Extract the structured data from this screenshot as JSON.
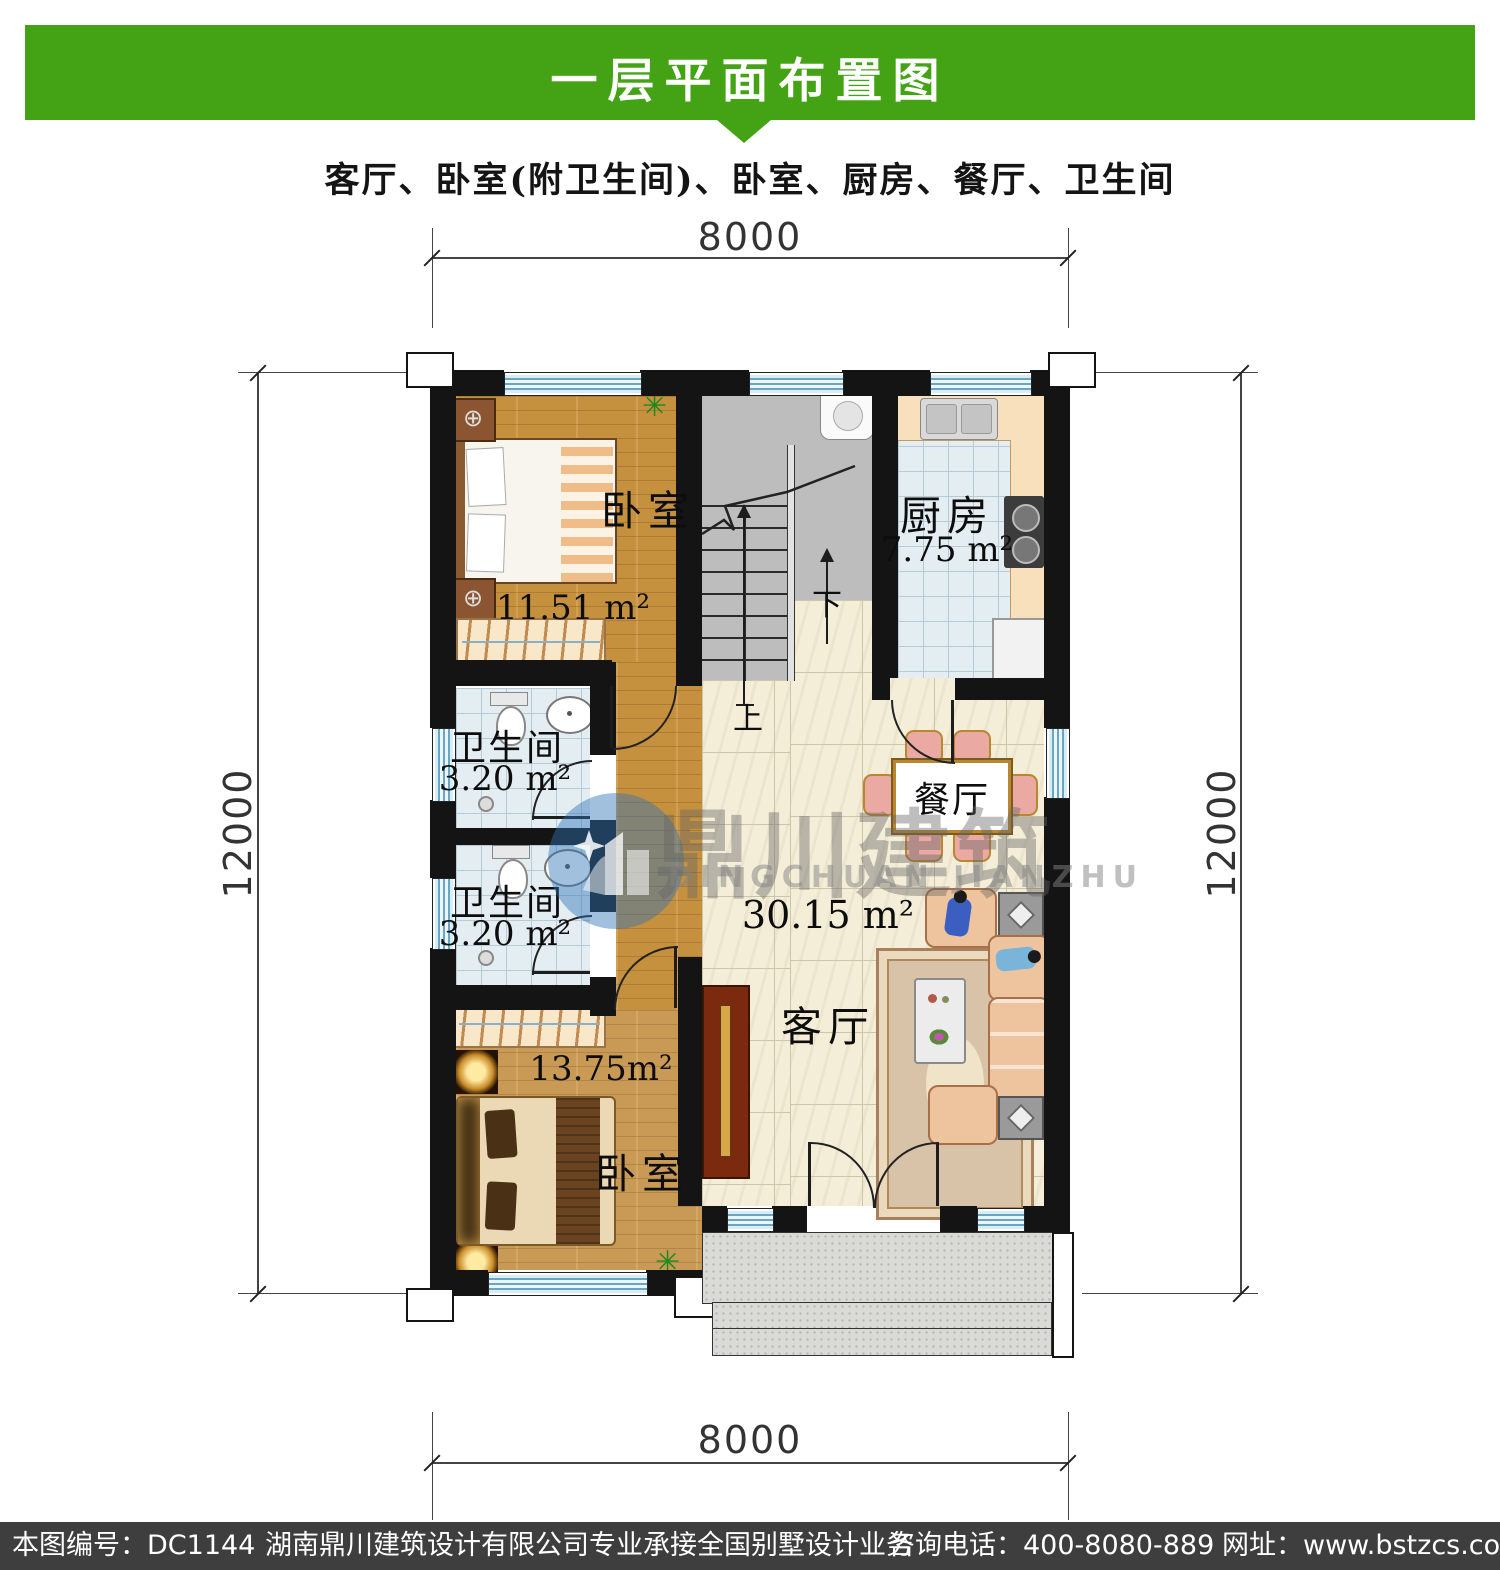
{
  "header": {
    "title": "一层平面布置图",
    "subtitle": "客厅、卧室(附卫生间)、卧室、厨房、餐厅、卫生间"
  },
  "dimensions": {
    "top": "8000",
    "bottom": "8000",
    "left": "12000",
    "right": "12000"
  },
  "rooms": {
    "bedroom_top": {
      "name": "卧室",
      "area": "11.51 m²"
    },
    "kitchen": {
      "name": "厨房",
      "area": "7.75 m²"
    },
    "bath_upper": {
      "name": "卫生间",
      "area": "3.20 m²"
    },
    "bath_lower": {
      "name": "卫生间",
      "area": "3.20 m²"
    },
    "dining": {
      "name": "餐厅"
    },
    "living": {
      "name": "客厅",
      "area": "30.15 m²"
    },
    "bedroom_bottom": {
      "name": "卧室",
      "area": "13.75m²"
    }
  },
  "stairs": {
    "up": "上",
    "down": "下"
  },
  "watermark": {
    "cn": "鼎川建筑",
    "en": "DINGCHUAN JIANZHU"
  },
  "footer": {
    "drawing_no": "本图编号：DC1144",
    "company": "湖南鼎川建筑设计有限公司专业承接全国别墅设计业务",
    "phone": "咨询电话：400-8080-889",
    "website": "网址：www.bstzcs.com"
  },
  "colors": {
    "accent_green": "#43a315",
    "wall": "#141414",
    "window_blue": "#6aa6c2",
    "wood_floor": "#c6913f",
    "tile_floor": "#e4edf2",
    "marble_floor": "#f4eed9",
    "stairs_gray": "#bdbdbd",
    "footer_bg": "#3e3e3e"
  }
}
